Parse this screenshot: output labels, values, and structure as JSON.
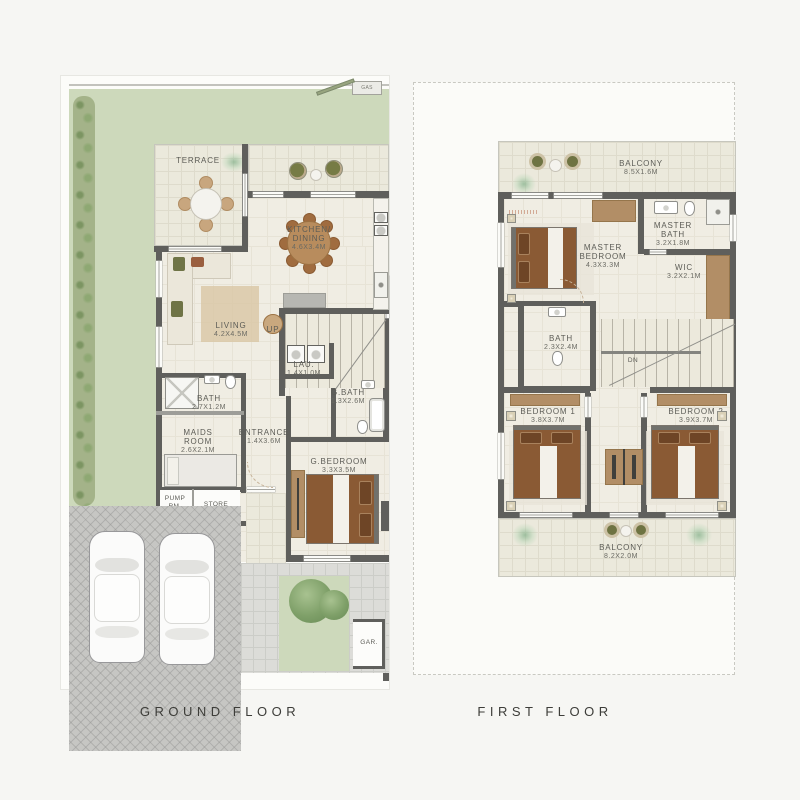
{
  "ground": {
    "caption": "GROUND FLOOR",
    "gas": "GAS",
    "terrace": {
      "name": "TERRACE"
    },
    "kitchen_dining": {
      "line1": "KITCHEN/",
      "line2": "DINING",
      "dims": "4.6X3.4M"
    },
    "living": {
      "name": "LIVING",
      "dims": "4.2X4.5M"
    },
    "stairs": {
      "direction": "UP"
    },
    "laundry": {
      "name": "LAU.",
      "dims": "1.4X1.0M"
    },
    "guest_bath": {
      "name": "G.BATH",
      "dims": "1.3X2.6M"
    },
    "bath": {
      "name": "BATH",
      "dims": "2.7X1.2M"
    },
    "maids_room": {
      "line1": "MAIDS",
      "line2": "ROOM",
      "dims": "2.6X2.1M"
    },
    "entrance": {
      "name": "ENTRANCE",
      "dims": "1.4X3.6M"
    },
    "guest_bedroom": {
      "name": "G.BEDROOM",
      "dims": "3.3X3.5M"
    },
    "pump_room": {
      "line1": "PUMP",
      "line2": "RM."
    },
    "store": {
      "name": "STORE"
    },
    "garage": {
      "name": "GAR."
    }
  },
  "first": {
    "caption": "FIRST FLOOR",
    "balcony_top": {
      "name": "BALCONY",
      "dims": "8.5X1.6M"
    },
    "master_bedroom": {
      "line1": "MASTER",
      "line2": "BEDROOM",
      "dims": "4.3X3.3M"
    },
    "master_bath": {
      "line1": "MASTER",
      "line2": "BATH",
      "dims": "3.2X1.8M"
    },
    "wic": {
      "name": "WIC",
      "dims": "3.2X2.1M"
    },
    "bath": {
      "name": "BATH",
      "dims": "2.3X2.4M"
    },
    "stairs": {
      "direction": "DN"
    },
    "bedroom_1": {
      "name": "BEDROOM 1",
      "dims": "3.8X3.7M"
    },
    "bedroom_2": {
      "name": "BEDROOM 2",
      "dims": "3.9X3.7M"
    },
    "balcony_bottom": {
      "name": "BALCONY",
      "dims": "8.2X2.0M"
    }
  }
}
